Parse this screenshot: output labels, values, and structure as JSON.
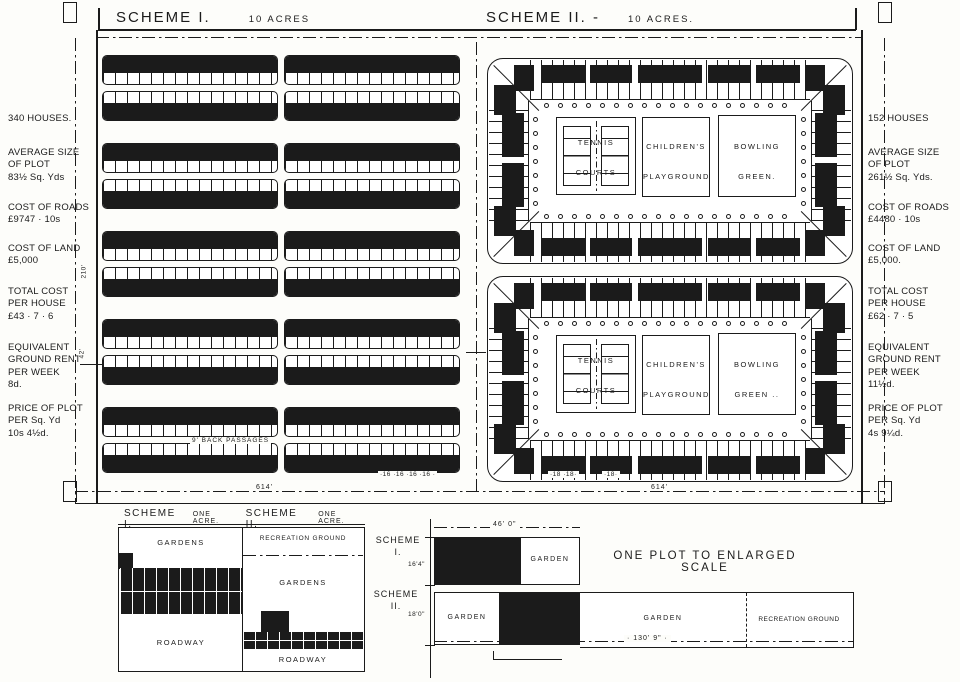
{
  "header": {
    "scheme1_title": "SCHEME I.",
    "scheme1_acres": "10 ACRES",
    "scheme2_title": "SCHEME II. -",
    "scheme2_acres": "10 ACRES."
  },
  "scheme1_stats": {
    "houses": "340 HOUSES.",
    "plot_size": "AVERAGE SIZE\nOF PLOT\n83½ Sq. Yds",
    "roads": "COST OF ROADS\n£9747 · 10s",
    "land": "COST OF LAND\n£5,000",
    "total": "TOTAL COST\nPER HOUSE\n£43 · 7 · 6",
    "rent": "EQUIVALENT\nGROUND RENT\nPER WEEK\n8d.",
    "plot_price": "PRICE OF PLOT\nPER Sq. Yd\n10s 4½d."
  },
  "scheme2_stats": {
    "houses": "152 HOUSES",
    "plot_size": "AVERAGE SIZE\nOF PLOT\n261½ Sq. Yds.",
    "roads": "COST OF ROADS\n£4480 · 10s",
    "land": "COST OF LAND\n£5,000.",
    "total": "TOTAL COST\nPER HOUSE\n£62 · 7 · 5",
    "rent": "EQUIVALENT\nGROUND RENT\nPER WEEK\n11½d.",
    "plot_price": "PRICE OF PLOT\nPER Sq. Yd\n4s 9¼d."
  },
  "plan": {
    "back_passages": "9' BACK PASSAGES",
    "dim_614_left": "614'",
    "dim_614_right": "614'",
    "dim_16s": "·16 ·16 ·16 ·16 ·",
    "dim_18s_a": "·18 ·18·",
    "dim_18s_b": "·18·",
    "dim_210": "210'",
    "dim_42": "42'",
    "amenities": {
      "tennis": "TENNIS\nCOURTS",
      "playground": "CHILDREN'S\nPLAYGROUND",
      "bowling_top": "BOWLING\nGREEN.",
      "bowling_bottom": "BOWLING\nGREEN .."
    }
  },
  "one_acre": {
    "scheme1_label": "SCHEME I.",
    "scheme1_sub": "ONE ACRE.",
    "scheme2_label": "SCHEME II.",
    "scheme2_sub": "ONE ACRE.",
    "s1_gardens": "GARDENS",
    "s1_roadway": "ROADWAY",
    "s2_recreation": "RECREATION GROUND",
    "s2_gardens": "GARDENS",
    "s2_roadway": "ROADWAY"
  },
  "enlarged": {
    "title": "ONE PLOT TO ENLARGED SCALE",
    "scheme1_label": "SCHEME\nI.",
    "scheme2_label": "SCHEME\nII.",
    "dim_width": "46' 0\"",
    "dim_depth1": "16'4\"",
    "dim_depth2": "18'0\"",
    "dim_length": "· 130' 9\" ·",
    "s1_garden": "GARDEN",
    "s2_garden_left": "GARDEN",
    "s2_garden_right": "GARDEN",
    "s2_recreation": "RECREATION GROUND"
  },
  "colors": {
    "ink": "#1b1b1b",
    "paper": "#fdfdfa"
  }
}
